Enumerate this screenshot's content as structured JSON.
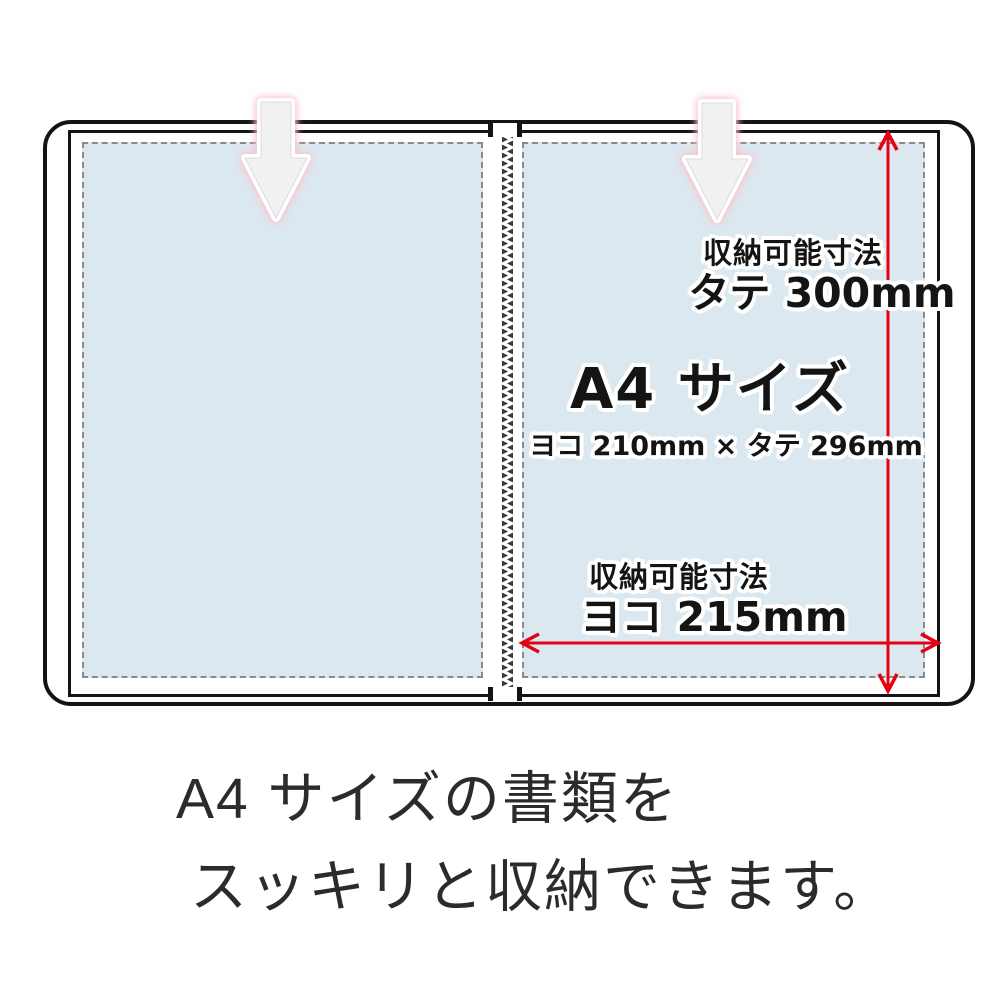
{
  "diagram": {
    "annotations": {
      "storable_label_vertical": "収納可能寸法",
      "vertical_value": "タテ 300mm",
      "a4_title": "A4 サイズ",
      "a4_dimensions": "ヨコ 210mm × タテ 296mm",
      "storable_label_horizontal": "収納可能寸法",
      "horizontal_value": "ヨコ 215mm"
    },
    "caption": {
      "line1": "A4 サイズの書類を",
      "line2": "スッキリと収納できます。"
    },
    "colors": {
      "pocket_blue": "#dce8f0",
      "dimension_red": "#e50012",
      "border_black": "#141414",
      "dashed_gray": "#8a8a8a",
      "arrow_fill": "#f2f1f2",
      "arrow_glow_pink": "#f6bac4",
      "caption_gray": "#2b2b2b"
    },
    "icons": {
      "insert_arrow": "insert-down-arrow-icon",
      "dimension_vertical": "vertical-dimension-arrow-icon",
      "dimension_horizontal": "horizontal-dimension-arrow-icon",
      "spine": "spine-stitch-pattern"
    }
  }
}
